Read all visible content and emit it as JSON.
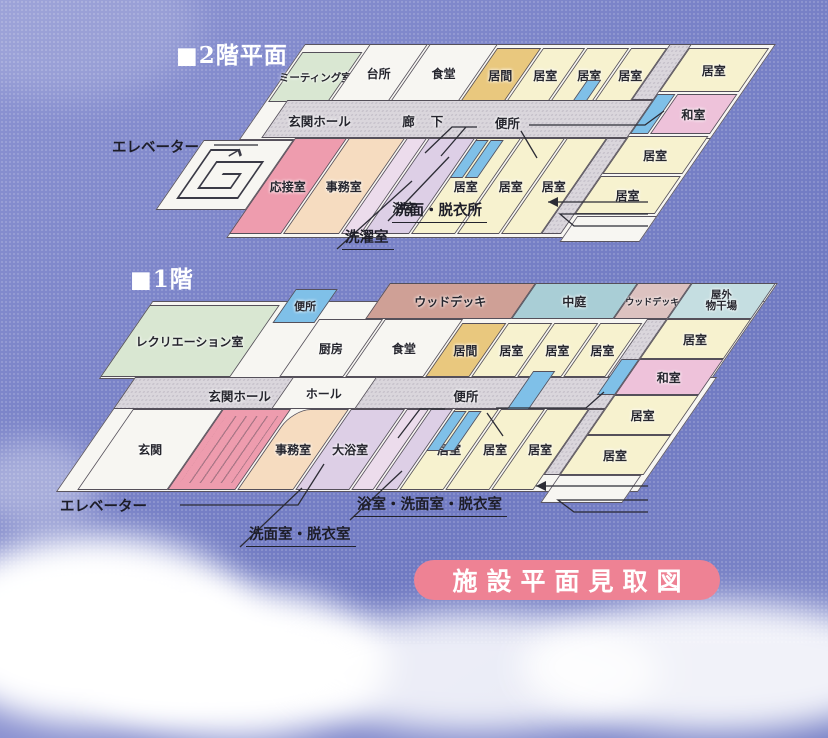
{
  "badge": {
    "label": "施設平面見取図"
  },
  "floor2": {
    "title": "■2階平面",
    "rooms": {
      "meeting": "ミーティング室",
      "kitchen": "台所",
      "dining": "食堂",
      "living": "居間",
      "room_a": "居室",
      "room_b": "居室",
      "room_c": "居室",
      "room_right_top": "居室",
      "washitsu": "和室",
      "room_right_mid": "居室",
      "room_right_low": "居室",
      "reception": "応接室",
      "office": "事務室",
      "bath": "浴室",
      "room_d": "居室",
      "room_e": "居室",
      "room_f": "居室"
    },
    "corridor": {
      "entrance_hall": "玄関ホール",
      "hallway": "廊下",
      "toilet": "便所"
    },
    "external": {
      "elevator": "エレベーター",
      "washroom": "洗面・脱衣所",
      "laundry": "洗濯室"
    }
  },
  "floor1": {
    "title": "■1階",
    "rooms": {
      "wood_deck": "ウッドデッキ",
      "courtyard": "中庭",
      "wood_deck2": "ウッドデッキ",
      "drying_area_line1": "屋外",
      "drying_area_line2": "物干場",
      "recreation": "レクリエーション室",
      "toilet_room": "便所",
      "kitchen": "厨房",
      "dining": "食堂",
      "living": "居間",
      "room_a": "居室",
      "room_b": "居室",
      "room_c": "居室",
      "room_right_top": "居室",
      "washitsu": "和室",
      "room_right_mid": "居室",
      "room_right_low": "居室",
      "entrance": "玄関",
      "office": "事務室",
      "large_bath": "大浴室",
      "room_d": "居室",
      "room_e": "居室",
      "room_f": "居室"
    },
    "corridor": {
      "entrance_hall": "玄関ホール",
      "hall": "ホール",
      "toilet": "便所"
    },
    "external": {
      "elevator": "エレベーター",
      "washroom": "洗面室・脱衣室",
      "bath_washroom": "浴室・洗面室・脱衣室"
    }
  },
  "colors": {
    "sky": "#7a83c8",
    "badge_pink": "#ee8294",
    "room_cream": "#f7f2cf",
    "room_green": "#d9e7d2",
    "room_tan": "#e9c87e",
    "room_pink": "#eec2da",
    "toilet_blue": "#7fc0e8",
    "room_lavender": "#ddcfe6",
    "room_peach": "#f6dcc0",
    "reception_pink": "#ee9cae",
    "deck_brown": "#cfa096",
    "courtyard_teal": "#a9ced6",
    "corridor_gray": "#dad6dc"
  }
}
